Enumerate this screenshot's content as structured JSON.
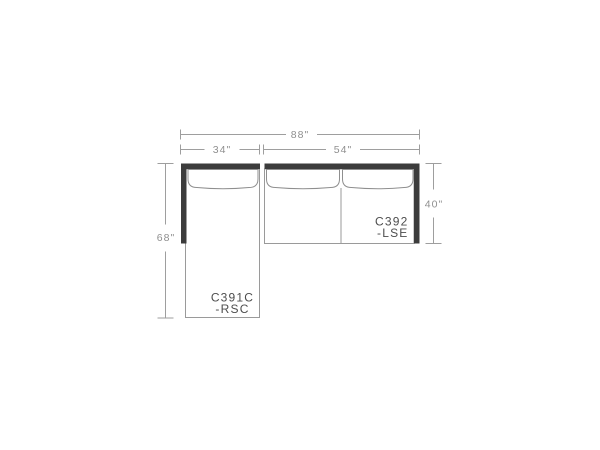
{
  "diagram": {
    "type": "sectional-sofa-dimension-drawing",
    "colors": {
      "background": "#ffffff",
      "frame_dark": "#3c3c3c",
      "body_outline": "#9a9a9a",
      "cushion_line": "#8f8f8f",
      "dimension_line": "#9e9e9e",
      "dimension_text": "#8f8f8f",
      "label_text": "#4d4d4d"
    },
    "dimensions": {
      "overall_width": "88\"",
      "chaise_width": "34\"",
      "sofa_width": "54\"",
      "chaise_depth": "68\"",
      "sofa_depth": "40\""
    },
    "pieces": {
      "chaise": {
        "model": "C391C",
        "suffix": "-RSC"
      },
      "sofa": {
        "model": "C392",
        "suffix": "-LSE"
      }
    }
  }
}
